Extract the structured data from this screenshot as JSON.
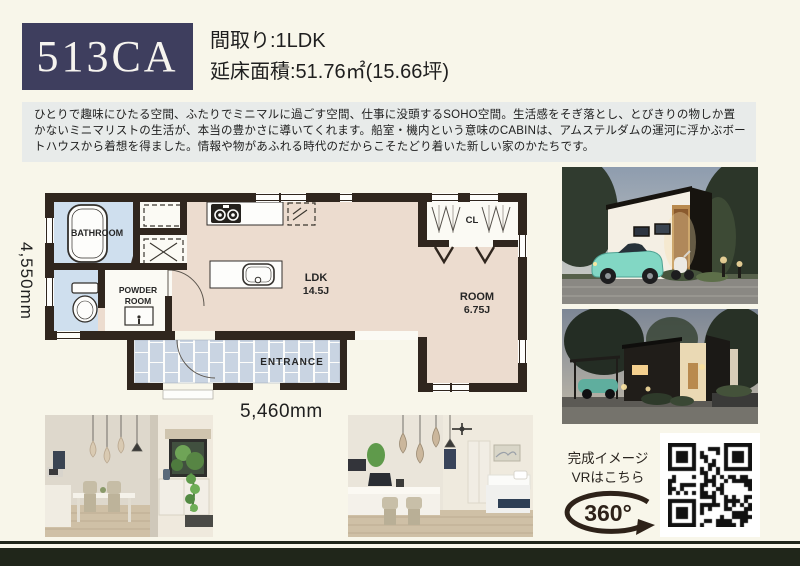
{
  "header": {
    "plan_code": "513CA",
    "layout": "間取り:1LDK",
    "floor_area": "延床面積:51.76㎡(15.66坪)"
  },
  "description": {
    "text": "ひとりで趣味にひたる空間、ふたりでミニマルに過ごす空間、仕事に没頭するSOHO空間。生活感をそぎ落とし、とびきりの物しか置かないミニマリストの生活が、本当の豊かさに導いてくれます。船室・機内という意味のCABINは、アムステルダムの運河に浮かぶボートハウスから着想を得ました。情報や物があふれる時代のだからこそたどり着いた新しい家のかたちです。"
  },
  "floorplan": {
    "dim_height": "4,550mm",
    "dim_width": "5,460mm",
    "labels": {
      "bathroom": "BATHROOM",
      "powder_line1": "POWDER",
      "powder_line2": "ROOM",
      "ldk": "LDK",
      "ldk_size": "14.5J",
      "room": "ROOM",
      "room_size": "6.75J",
      "closet": "CL",
      "entrance": "ENTRANCE"
    }
  },
  "vr": {
    "caption_line1": "完成イメージ",
    "caption_line2": "VRはこちら",
    "badge": "360°"
  },
  "colors": {
    "cream": "#f8f6ea",
    "navy": "#3e3e5e",
    "panel": "#e8ebea",
    "ink": "#1f1f1f",
    "wall": "#30261e",
    "floor": "#ecdccf",
    "wet": "#cfdfee",
    "tile": "#c9d4e2",
    "bar": "#20261a"
  }
}
